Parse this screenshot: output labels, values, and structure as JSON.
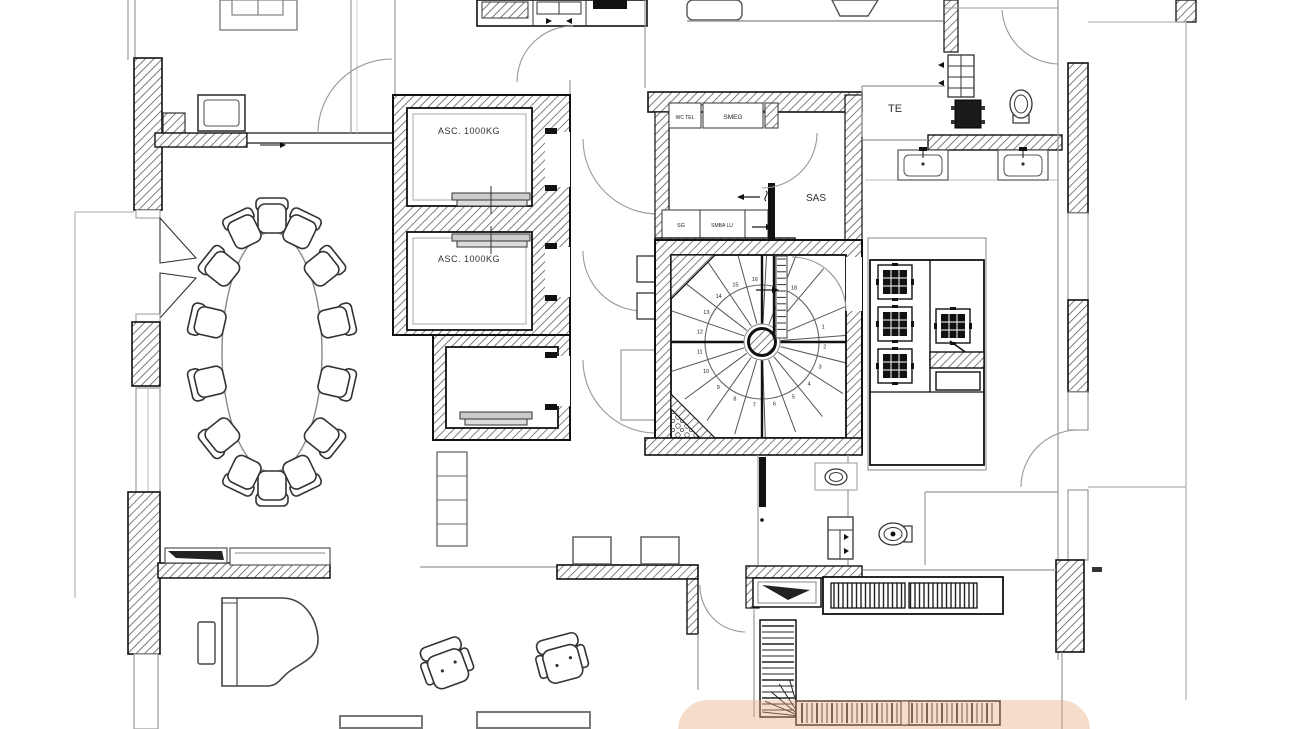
{
  "title": "Architectural floor plan",
  "colors": {
    "wall_line": "#1a1a1a",
    "thin_line": "#999999",
    "furniture_line": "#444444",
    "hatch_line": "#555555",
    "paper": "#ffffff",
    "highlight": "rgba(232,168,124,0.40)"
  },
  "labels": {
    "elevator_1": "ASC. 1000KG",
    "elevator_2": "ASC. 1000KG",
    "wc_tel": "WC TEL",
    "smeg": "SMEG",
    "sg": "SG",
    "smba_lu": "SMBA LU",
    "sas": "SAS",
    "te": "TE"
  },
  "spiral_staircase": {
    "steps": [
      "1",
      "2",
      "3",
      "4",
      "5",
      "6",
      "7",
      "8",
      "9",
      "10",
      "11",
      "12",
      "13",
      "14",
      "15",
      "16",
      "17",
      "18"
    ]
  },
  "conference_table": {
    "chair_count": 14
  },
  "lounge": {
    "armchair_count": 2
  },
  "kitchen": {
    "burner_count": 4
  },
  "gate": {
    "rungs": 12
  },
  "lower_staircase": {
    "vertical_treads": 15,
    "fan_treads": 5,
    "horizontal_treads_group1": 20,
    "horizontal_treads_group2": 17
  }
}
